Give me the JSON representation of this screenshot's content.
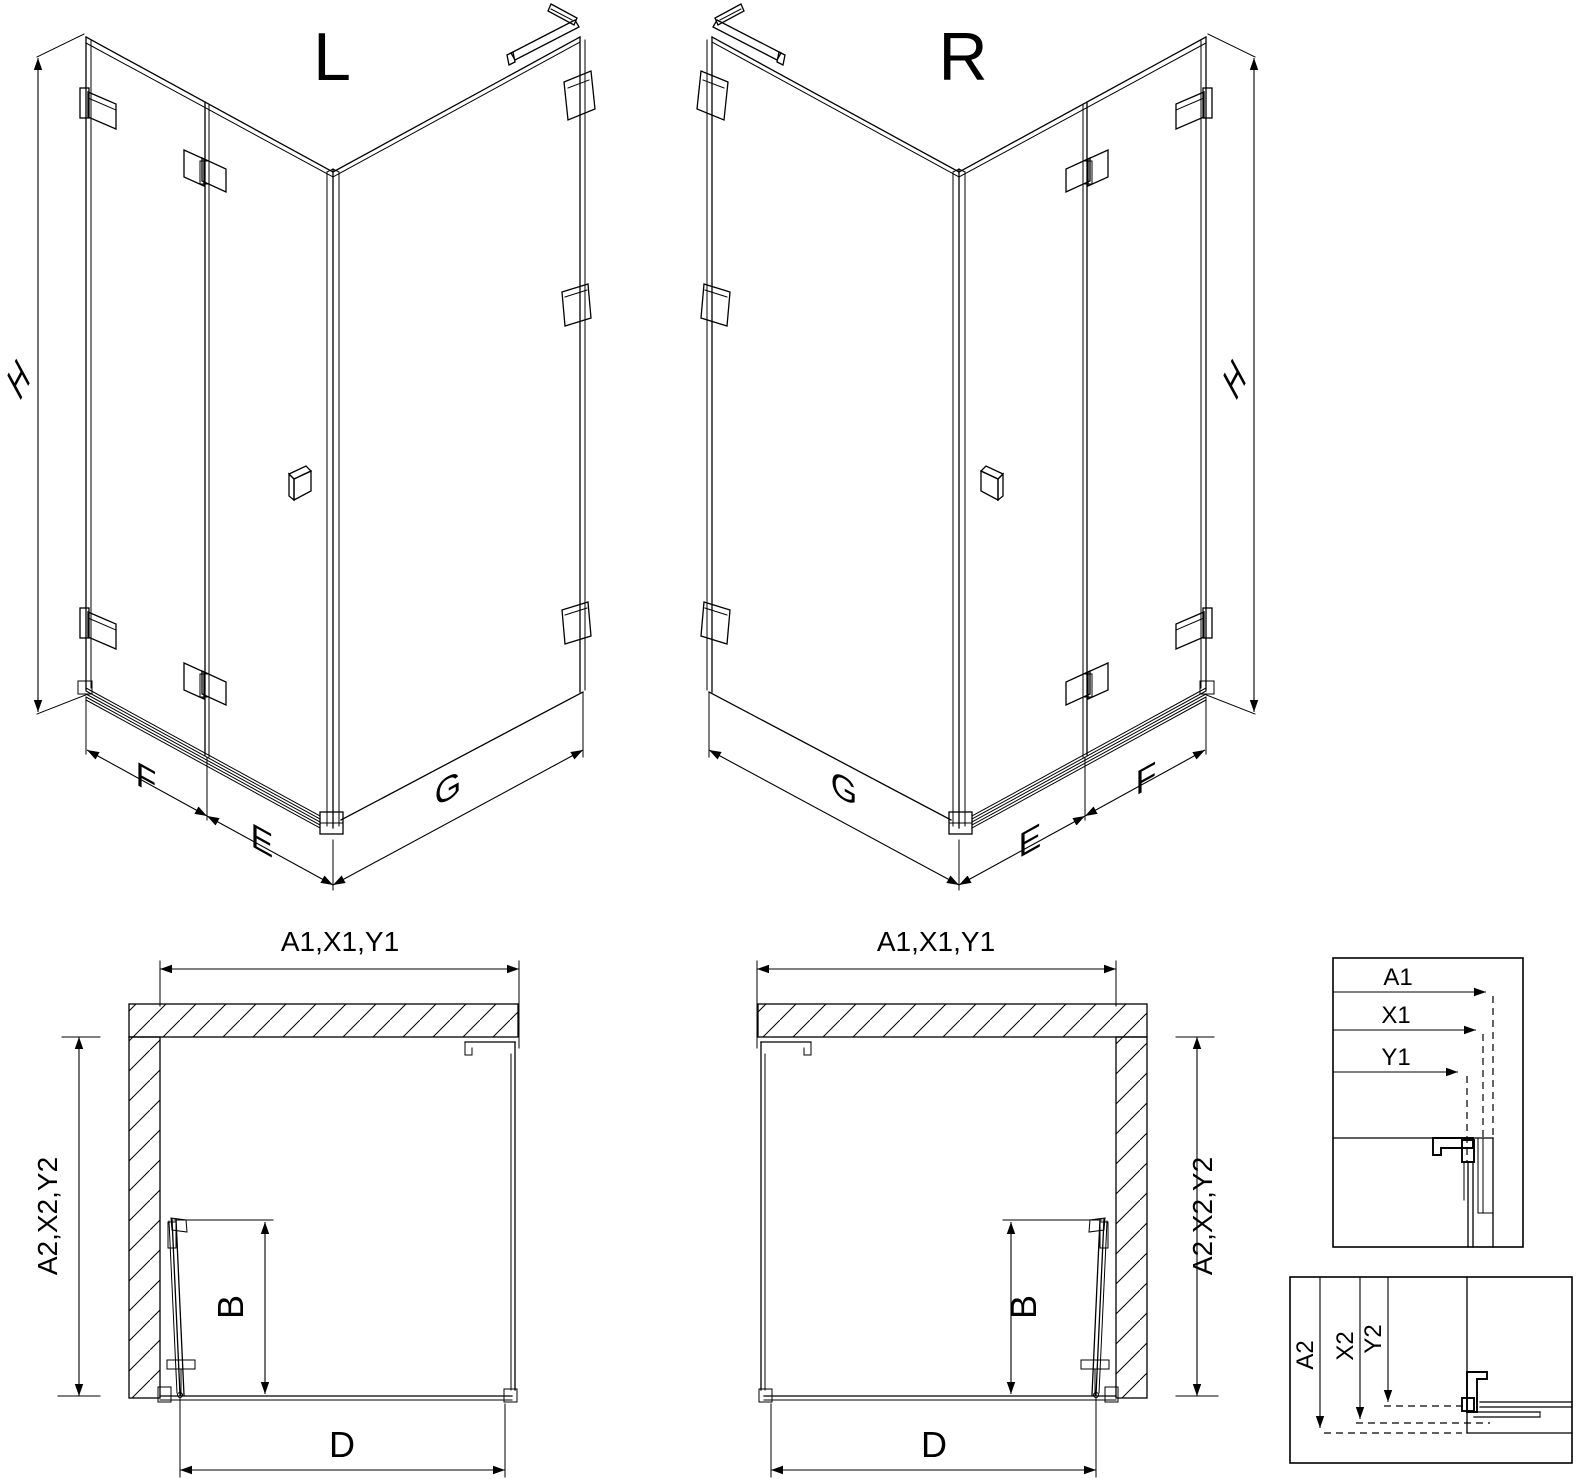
{
  "page": {
    "background": "#ffffff",
    "line_color": "#000000"
  },
  "iso_left": {
    "variant": "L",
    "dim_height": "H",
    "dim_panel_f": "F",
    "dim_door_e": "E",
    "dim_side_g": "G"
  },
  "iso_right": {
    "variant": "R",
    "dim_height": "H",
    "dim_side_g": "G",
    "dim_door_e": "E",
    "dim_panel_f": "F"
  },
  "plan_left": {
    "dim_width": "A1,X1,Y1",
    "dim_depth": "A2,X2,Y2",
    "dim_door": "B",
    "dim_entry": "D"
  },
  "plan_right": {
    "dim_width": "A1,X1,Y1",
    "dim_depth": "A2,X2,Y2",
    "dim_door": "B",
    "dim_entry": "D"
  },
  "detail_width": {
    "dim_a1": "A1",
    "dim_x1": "X1",
    "dim_y1": "Y1"
  },
  "detail_depth": {
    "dim_a2": "A2",
    "dim_x2": "X2",
    "dim_y2": "Y2"
  }
}
